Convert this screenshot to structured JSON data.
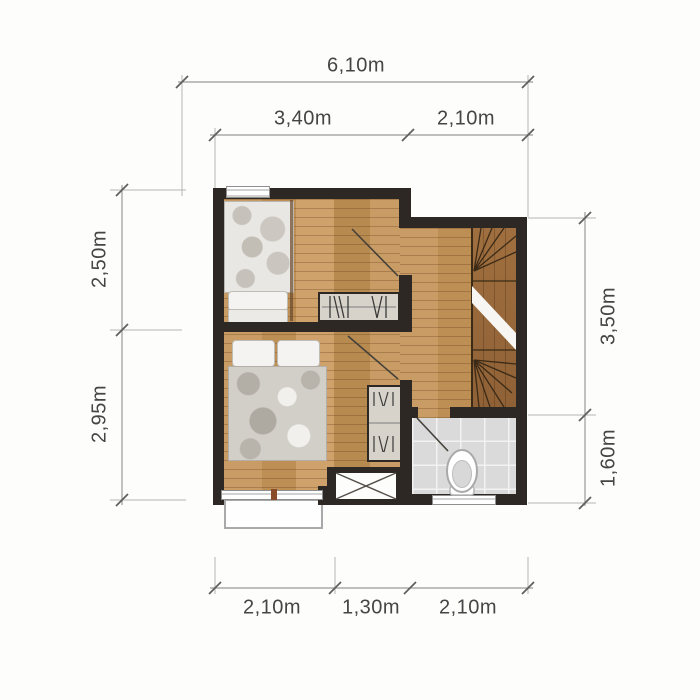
{
  "dimensions": {
    "top_total": "6,10m",
    "top_segment_left": "3,40m",
    "top_segment_right": "2,10m",
    "left_upper": "2,50m",
    "left_lower": "2,95m",
    "right_upper": "3,50m",
    "right_lower": "1,60m",
    "bottom_left": "2,10m",
    "bottom_middle": "1,30m",
    "bottom_right": "2,10m"
  },
  "elements": {
    "furniture_icons": [
      "single-bed",
      "double-bed",
      "dresser",
      "wardrobe",
      "staircase",
      "toilet",
      "crossed-void-box",
      "balcony",
      "windows",
      "door-swings"
    ]
  },
  "colors": {
    "wall": "#2d2823",
    "wood_floor": "#c69b64",
    "stair_wood": "#9c6d3f",
    "bathroom_tile": "#dadada",
    "furniture_gray": "#d8d3ca",
    "dimension_text": "#454545",
    "dimension_line": "#9a9a9a"
  }
}
